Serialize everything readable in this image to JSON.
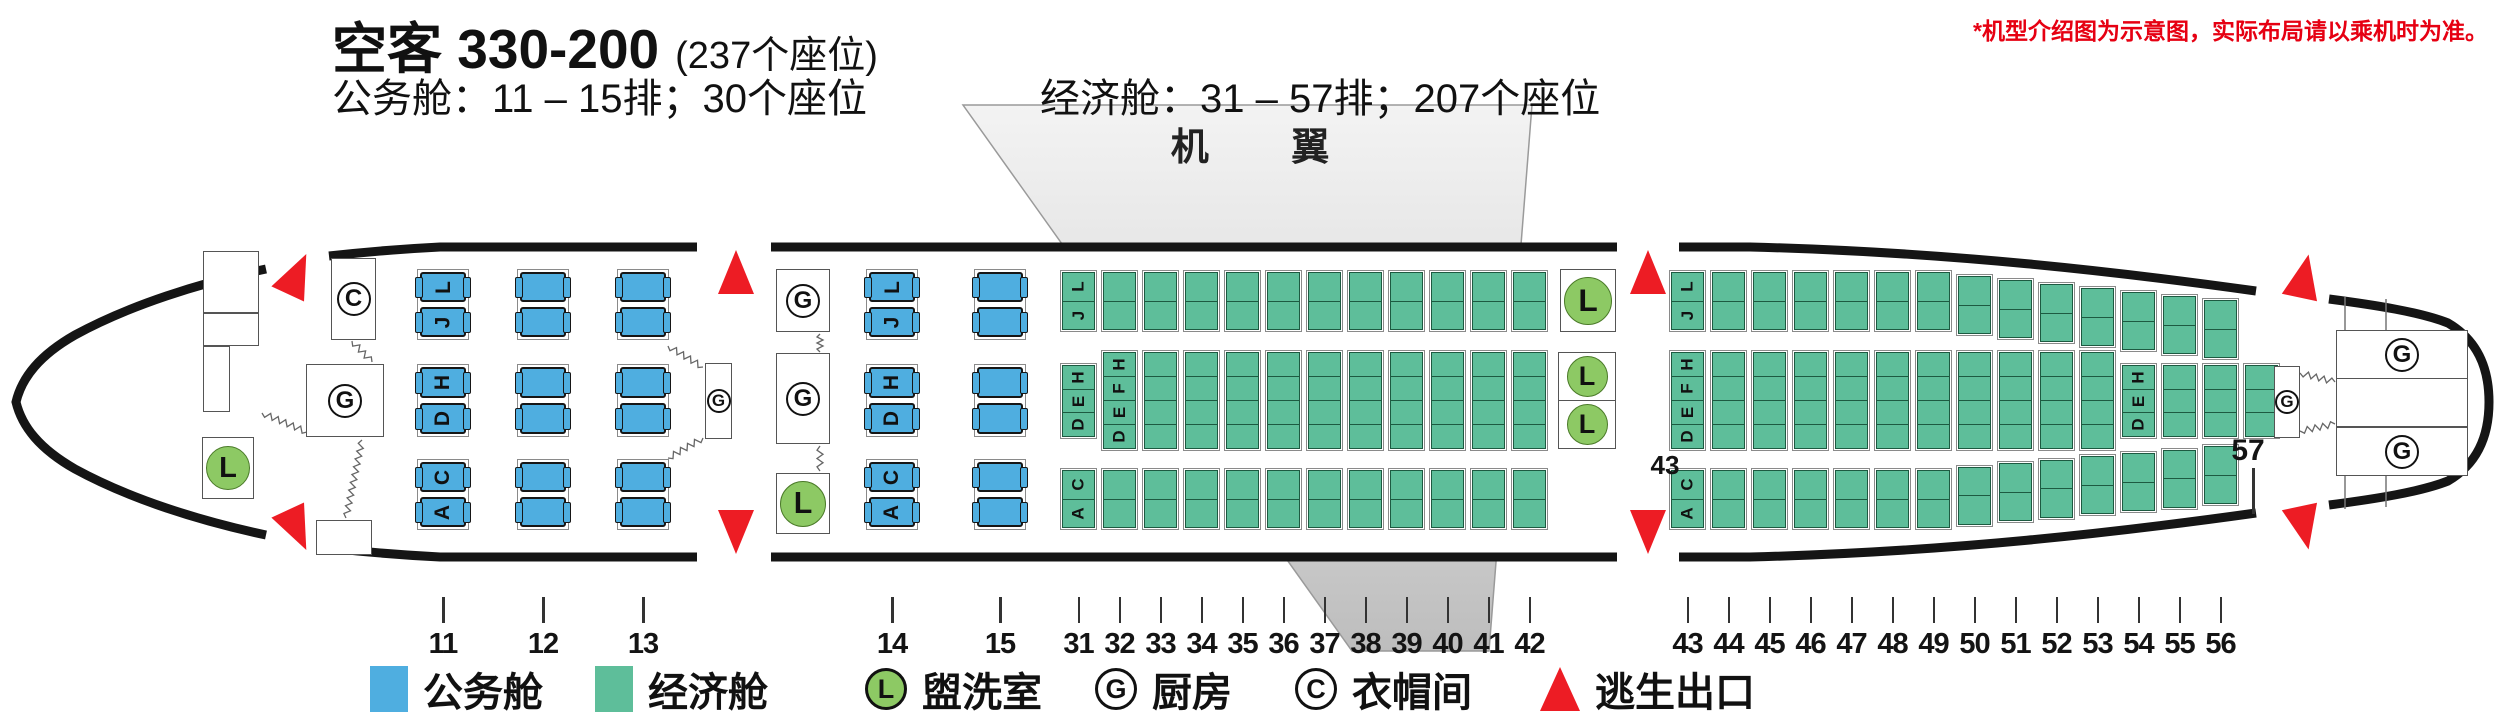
{
  "header": {
    "title": "空客 330-200",
    "seats_total": "(237个座位)",
    "business_info": "公务舱：11 – 15排；30个座位",
    "economy_info": "经济舱：31 – 57排；207个座位",
    "disclaimer": "*机型介绍图为示意图，实际布局请以乘机时为准。"
  },
  "wing_label": "机 翼",
  "legend": {
    "business": {
      "label": "公务舱",
      "color": "#4FAEE0"
    },
    "economy": {
      "label": "经济舱",
      "color": "#5EBE9A"
    },
    "lavatory": {
      "label": "盥洗室",
      "symbol": "L",
      "color": "#8DC964"
    },
    "galley": {
      "label": "厨房",
      "symbol": "G"
    },
    "closet": {
      "label": "衣帽间",
      "symbol": "C"
    },
    "exit": {
      "label": "逃生出口",
      "color": "#ED1C24"
    }
  },
  "seat_map": {
    "business": {
      "seat_color": "#4FAEE0",
      "band_letters": [
        [
          "L",
          "J"
        ],
        [
          "H",
          "D"
        ],
        [
          "C",
          "A"
        ]
      ],
      "sections": [
        {
          "rows": [
            "11",
            "12",
            "13"
          ]
        },
        {
          "rows": [
            "14",
            "15"
          ]
        }
      ]
    },
    "economy": {
      "seat_color": "#5EBE9A",
      "sections": [
        {
          "rows": [
            "31",
            "32",
            "33",
            "34",
            "35",
            "36",
            "37",
            "38",
            "39",
            "40",
            "41",
            "42"
          ],
          "top_letters": [
            "L",
            "J"
          ],
          "bottom_letters": [
            "C",
            "A"
          ],
          "middle_cols": [
            {
              "row": "31",
              "seats": 3,
              "letters": [
                "H",
                "E",
                "D"
              ]
            },
            {
              "row": "32",
              "seats": 4,
              "letters": [
                "H",
                "F",
                "E",
                "D"
              ]
            },
            {
              "row": "33",
              "seats": 4
            },
            {
              "row": "34",
              "seats": 4
            },
            {
              "row": "35",
              "seats": 4
            },
            {
              "row": "36",
              "seats": 4
            },
            {
              "row": "37",
              "seats": 4
            },
            {
              "row": "38",
              "seats": 4
            },
            {
              "row": "39",
              "seats": 4
            },
            {
              "row": "40",
              "seats": 4
            },
            {
              "row": "41",
              "seats": 4
            },
            {
              "row": "42",
              "seats": 4
            }
          ]
        },
        {
          "rows": [
            "43",
            "44",
            "45",
            "46",
            "47",
            "48",
            "49",
            "50",
            "51",
            "52",
            "53",
            "54",
            "55",
            "56"
          ],
          "top_letters": [
            "L",
            "J"
          ],
          "bottom_letters": [
            "C",
            "A"
          ],
          "middle_cols": [
            {
              "row": "43",
              "seats": 4,
              "letters": [
                "H",
                "F",
                "E",
                "D"
              ]
            },
            {
              "row": "44",
              "seats": 4
            },
            {
              "row": "45",
              "seats": 4
            },
            {
              "row": "46",
              "seats": 4
            },
            {
              "row": "47",
              "seats": 4
            },
            {
              "row": "48",
              "seats": 4
            },
            {
              "row": "49",
              "seats": 4
            },
            {
              "row": "50",
              "seats": 4
            },
            {
              "row": "51",
              "seats": 4
            },
            {
              "row": "52",
              "seats": 4
            },
            {
              "row": "53",
              "seats": 4
            },
            {
              "row": "54",
              "seats": 3,
              "letters": [
                "H",
                "E",
                "D"
              ]
            },
            {
              "row": "55",
              "seats": 3
            },
            {
              "row": "56",
              "seats": 3
            },
            {
              "row": "57",
              "seats": 3
            }
          ]
        }
      ]
    }
  },
  "row_callouts": {
    "row43": "43",
    "row57": "57"
  },
  "facility_symbols": {
    "lavatory": "L",
    "galley": "G",
    "closet": "C"
  }
}
